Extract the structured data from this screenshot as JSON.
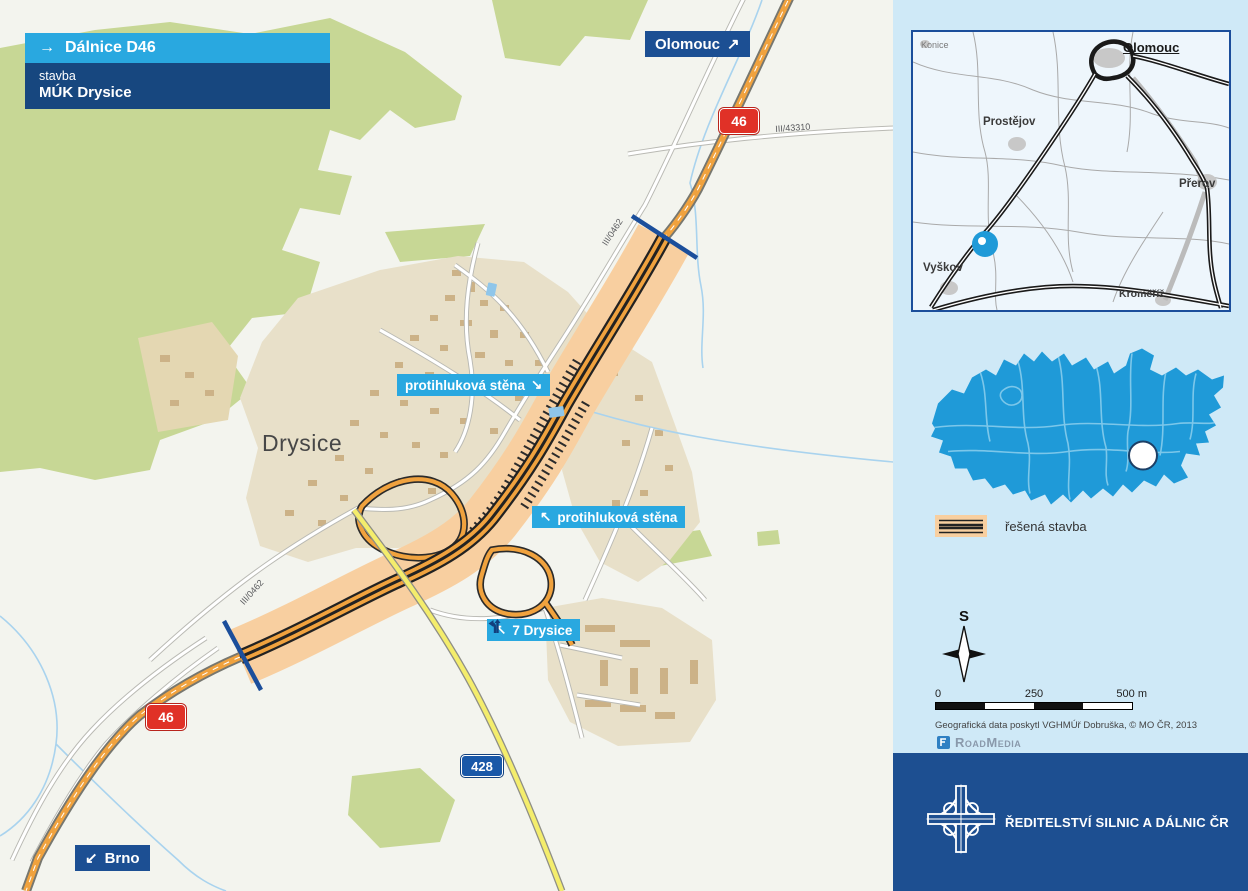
{
  "header": {
    "icon": "→",
    "route": "Dálnice D46",
    "construction_word": "stavba",
    "project": "MÚK Drysice"
  },
  "map_labels": {
    "place": "Drysice",
    "to_olomouc": {
      "text": "Olomouc",
      "arrow": "↗"
    },
    "to_brno": {
      "text": "Brno",
      "arrow": "↙"
    },
    "shield_46": "46",
    "shield_428": "428",
    "road_iii_43310": "III/43310",
    "road_iii_0462": "III/0462",
    "noise_wall_1": {
      "text": "protihluková stěna",
      "arrow": "↘"
    },
    "noise_wall_2": {
      "text": "protihluková stěna",
      "arrow": "↖"
    },
    "exit": {
      "text": "7 Drysice",
      "arrow": "↖"
    }
  },
  "sidebar": {
    "inset": {
      "cities": [
        "Konice",
        "Olomouc",
        "Prostějov",
        "Přerov",
        "Vyškov",
        "Kroměříž"
      ]
    },
    "legend": {
      "label": "řešená stavba"
    },
    "compass": {
      "north": "S"
    },
    "scale": {
      "t0": "0",
      "t1": "250",
      "t2": "500 m"
    },
    "credits": "Geografická data poskytl VGHMÚř Dobruška, © MO ČR, 2013",
    "brand": "RoadMedia",
    "footer": {
      "org": "ŘEDITELSTVÍ SILNIC A DÁLNIC ČR"
    }
  },
  "colors": {
    "accent_light_blue": "#29a8e0",
    "dark_blue": "#1d4f91",
    "corridor_orange": "#f8cfa0",
    "road_orange": "#f0a23e",
    "yellow_road": "#f4ed6c",
    "shield_red": "#e03127",
    "shield_blue": "#1958a8",
    "czech_map_blue": "#1f9ad8",
    "sidebar_bg": "#cfe9f7",
    "forest_green": "#c7d795",
    "village_beige": "#e8e0c9",
    "boundary_blue": "#1b4e9b"
  }
}
